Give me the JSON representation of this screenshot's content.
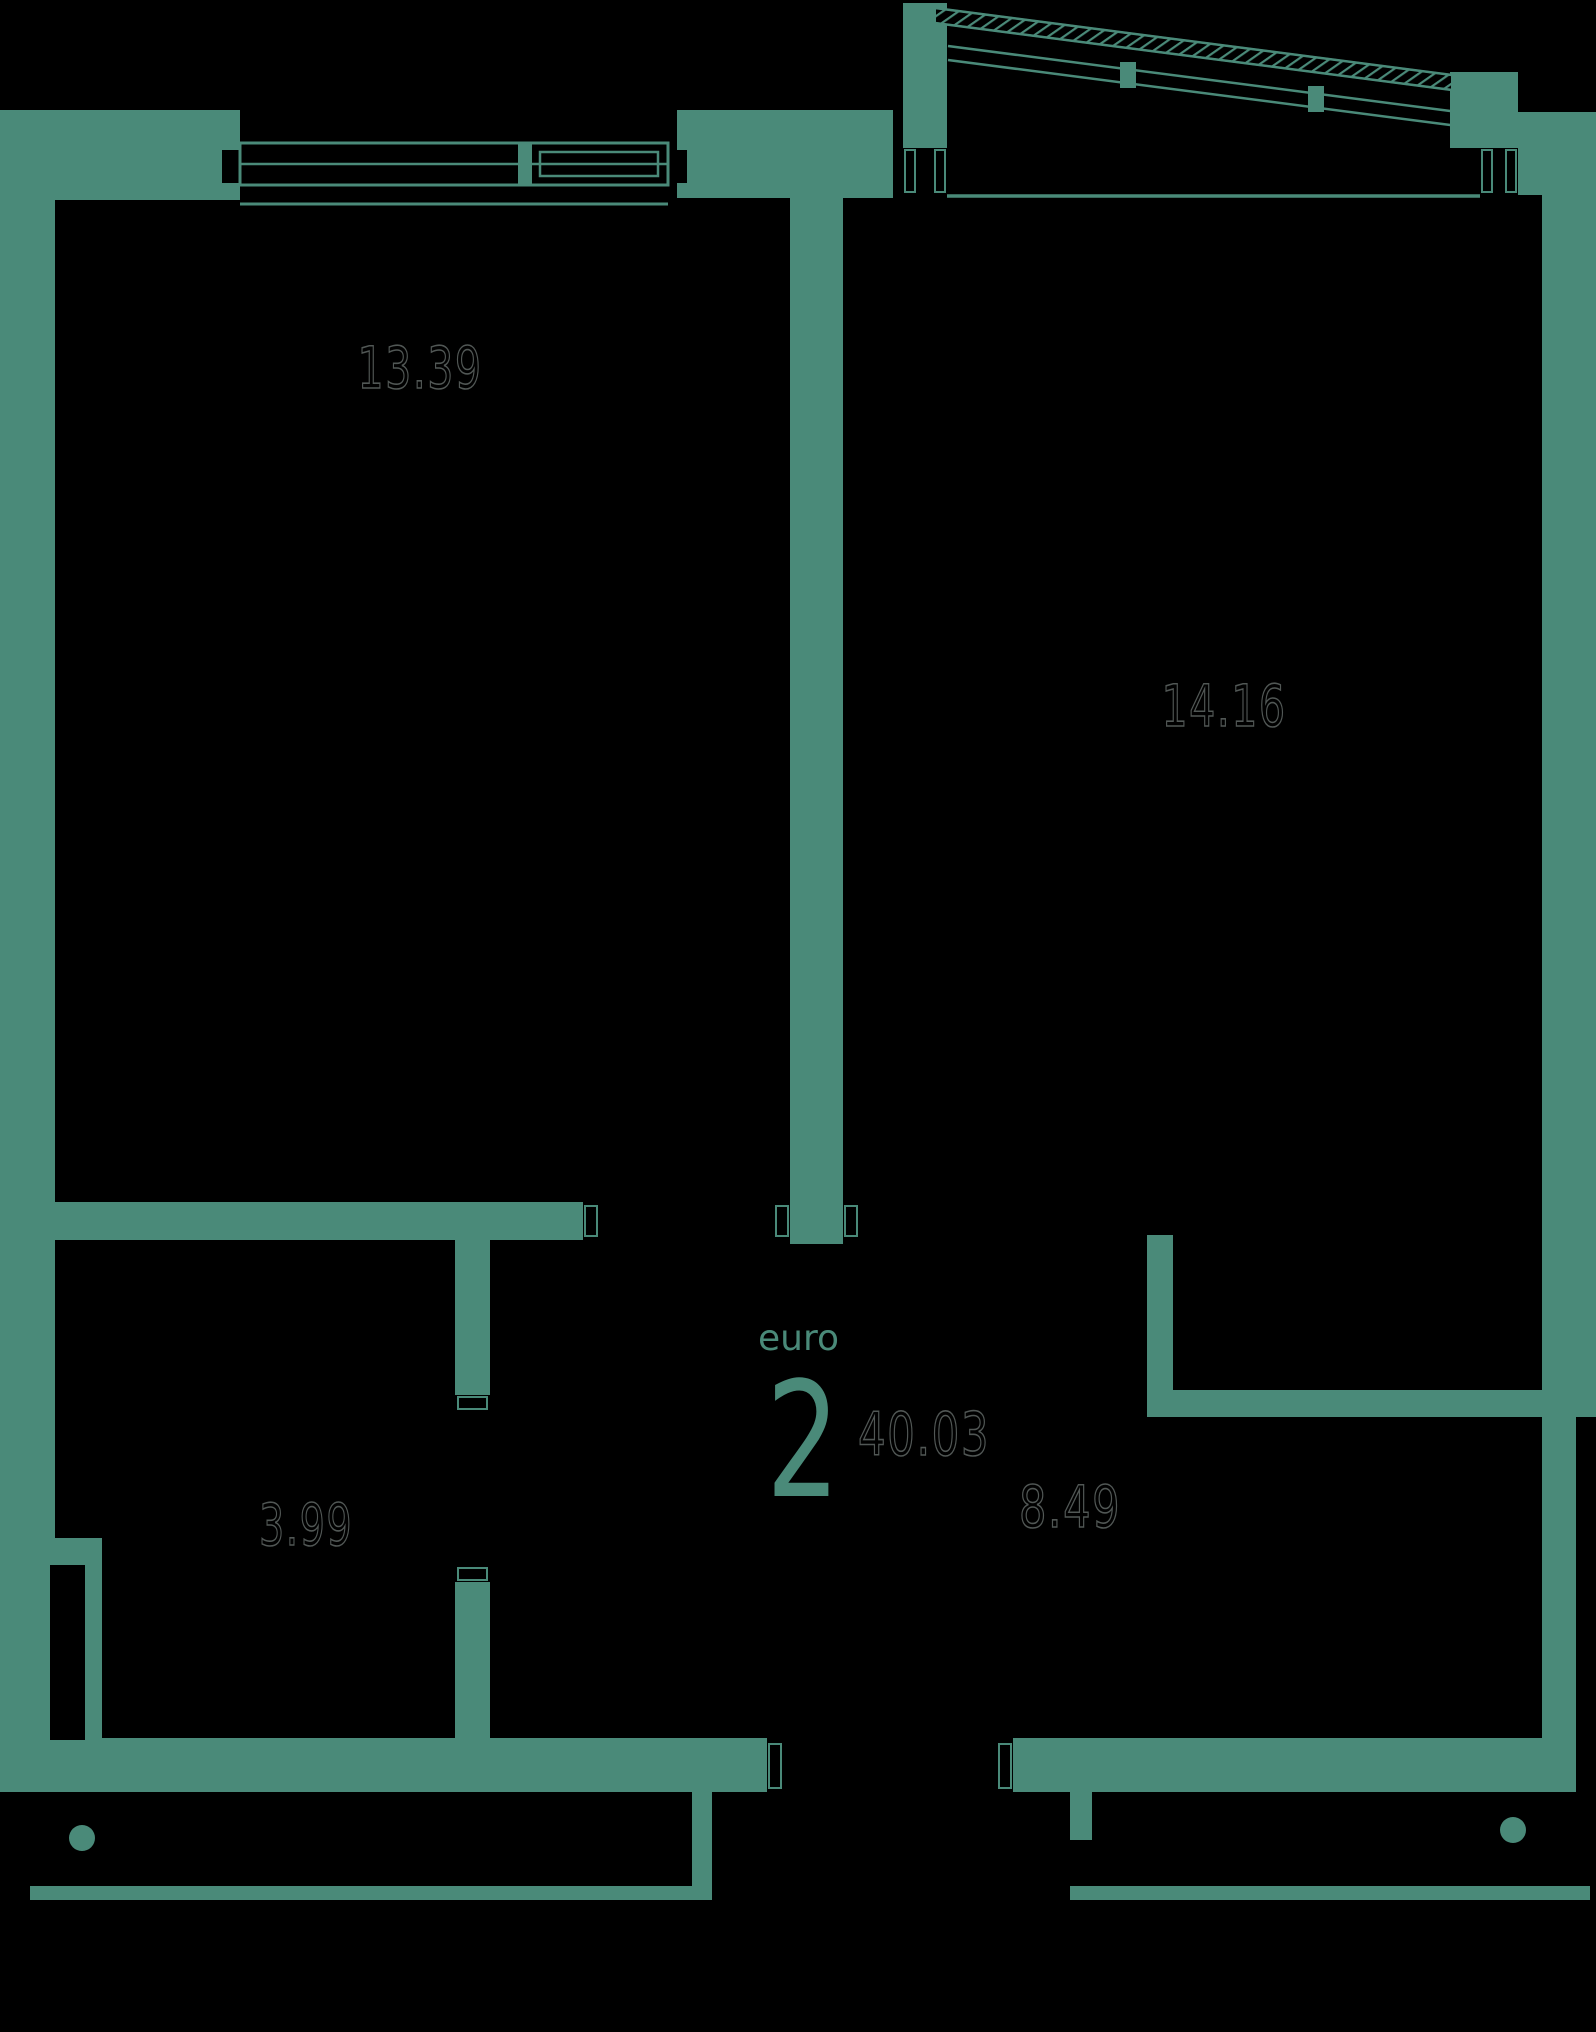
{
  "plan": {
    "title": "apartment-floor-plan",
    "unit": {
      "type_label": "euro",
      "type_number": "2",
      "total_area": "40.03"
    },
    "rooms": [
      {
        "id": "room-top-left",
        "area": "13.39"
      },
      {
        "id": "room-top-right",
        "area": "14.16"
      },
      {
        "id": "room-bottom-left",
        "area": "3.99"
      },
      {
        "id": "room-bottom-right",
        "area": "8.49"
      }
    ],
    "colors": {
      "wall": "#4A8A79",
      "background": "#000000",
      "area_text_outline": "#515755"
    }
  }
}
